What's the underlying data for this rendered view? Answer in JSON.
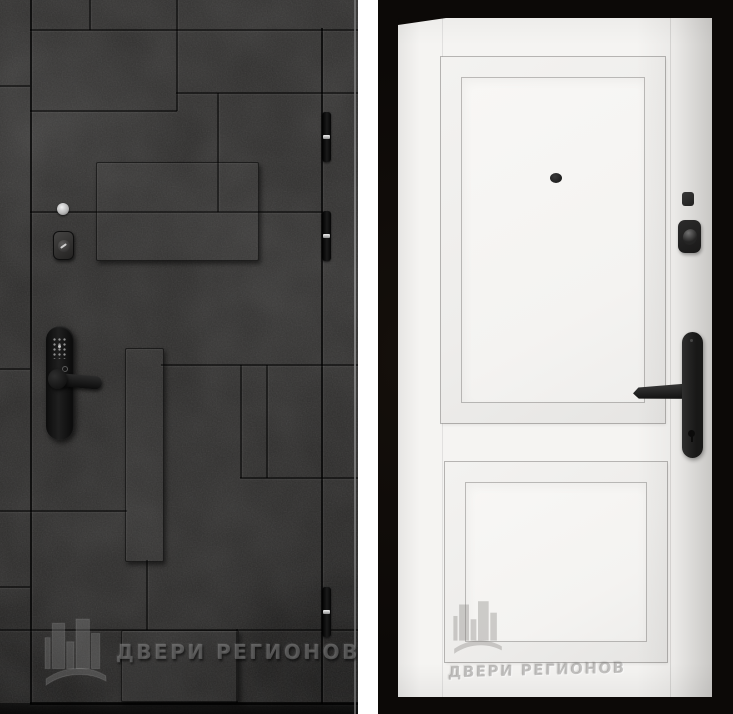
{
  "watermark": {
    "text": "ДВЕРИ РЕГИОНОВ",
    "logo": "buildings-skyline-icon"
  },
  "photos": {
    "left": {
      "subject": "entrance-door-exterior-side",
      "finish": "dark graphite concrete with geometric recessed seams and raised planks",
      "colors": {
        "base": "#2c2b2a",
        "seam": "#161616",
        "hardware": "#111111",
        "watermark": "#9e9e9e"
      },
      "hardware": {
        "peephole": "silver-peephole",
        "cylinder": "black-cylinder-escutcheon",
        "smart_lock": "black-keypad-smart-lock-with-lever",
        "hinges": 3
      }
    },
    "right": {
      "subject": "entrance-door-interior-side",
      "finish": "white classic finish with two raised molded panels",
      "colors": {
        "background": "#0c0907",
        "door": "#f5f4f2",
        "hardware": "#1d1d1d",
        "watermark": "#a8a6a4"
      },
      "hardware": {
        "peephole": "black-peephole",
        "night_latch": "black-square-latch",
        "thumbturn": "black-thumbturn-lock",
        "handle": "black-lever-on-long-backplate-with-keyhole"
      }
    }
  }
}
